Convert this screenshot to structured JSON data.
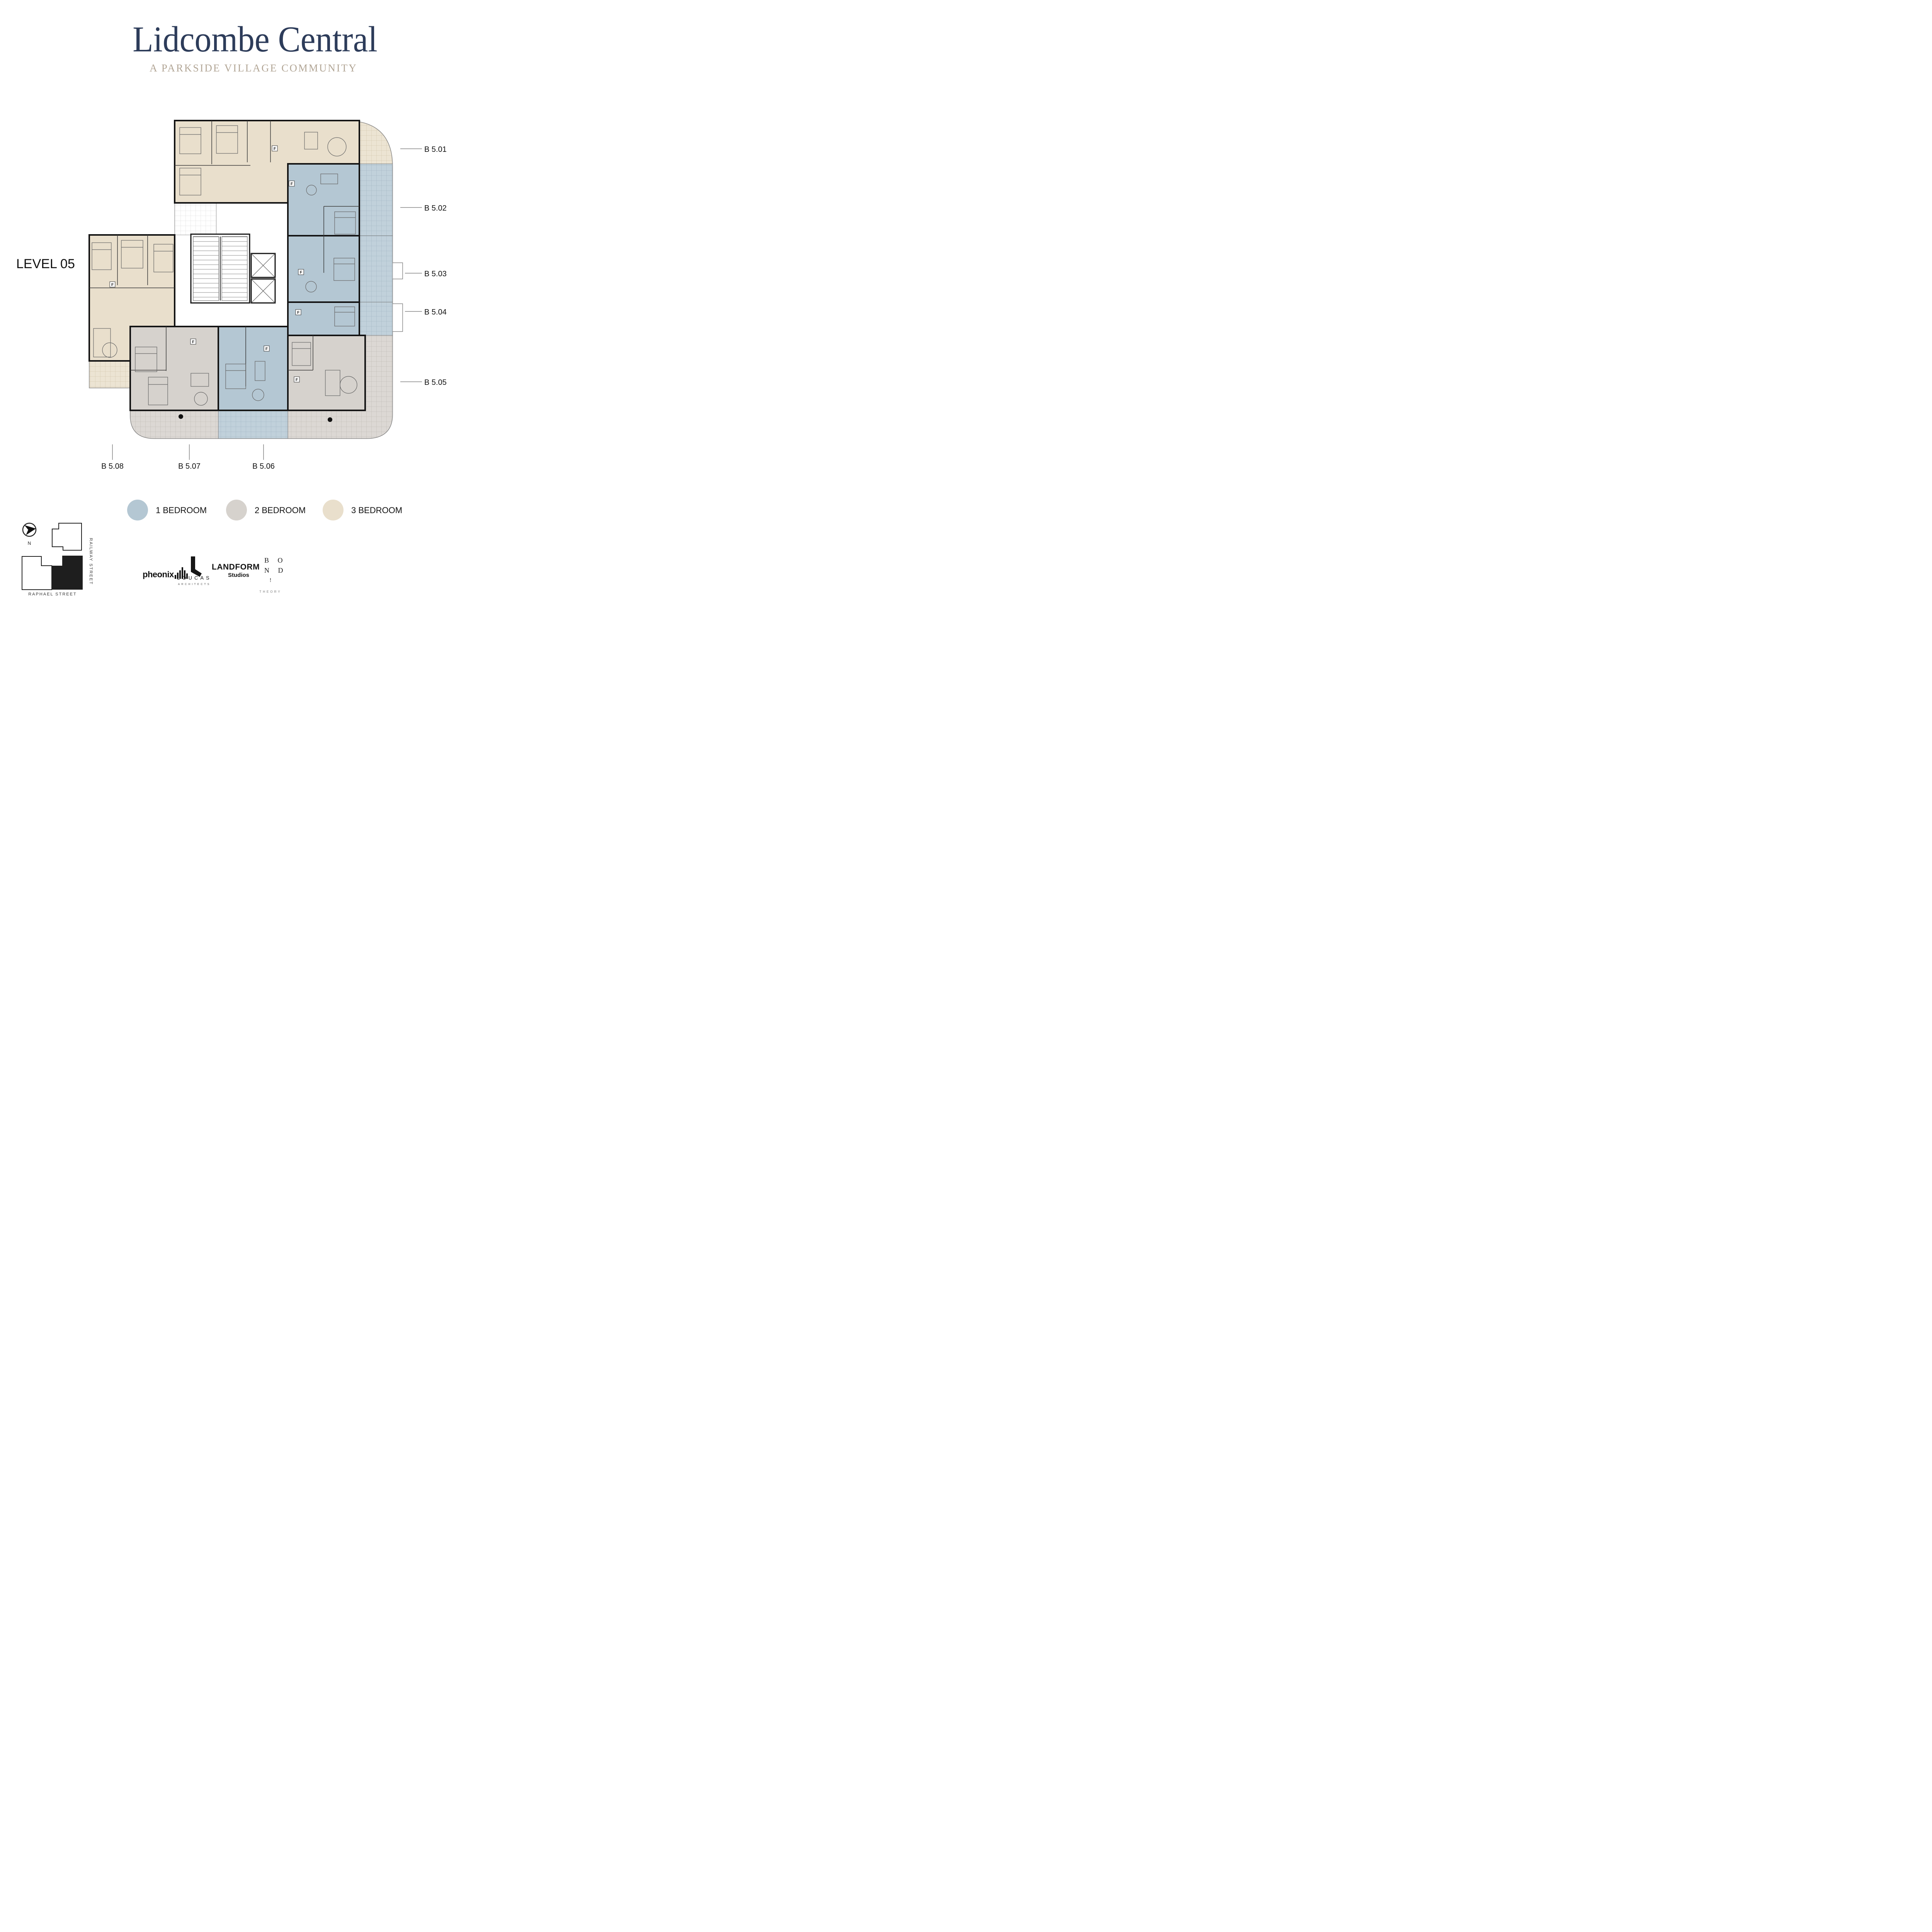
{
  "header": {
    "title": "Lidcombe Central",
    "subtitle": "A PARKSIDE VILLAGE COMMUNITY"
  },
  "plan": {
    "level_label": "LEVEL 05",
    "f_marker_label": "F",
    "units": [
      {
        "id": "B5.01",
        "label": "B 5.01",
        "type": "3 Bedroom",
        "label_side": "right"
      },
      {
        "id": "B5.02",
        "label": "B 5.02",
        "type": "1 Bedroom",
        "label_side": "right"
      },
      {
        "id": "B5.03",
        "label": "B 5.03",
        "type": "1 Bedroom",
        "label_side": "right"
      },
      {
        "id": "B5.04",
        "label": "B 5.04",
        "type": "1 Bedroom",
        "label_side": "right"
      },
      {
        "id": "B5.05",
        "label": "B 5.05",
        "type": "2 Bedroom",
        "label_side": "right"
      },
      {
        "id": "B5.06",
        "label": "B 5.06",
        "type": "1 Bedroom",
        "label_side": "bottom"
      },
      {
        "id": "B5.07",
        "label": "B 5.07",
        "type": "2 Bedroom",
        "label_side": "bottom"
      },
      {
        "id": "B5.08",
        "label": "B 5.08",
        "type": "3 Bedroom",
        "label_side": "bottom"
      }
    ]
  },
  "legend": {
    "items": [
      {
        "label": "1 BEDROOM",
        "color": "#b4c7d3"
      },
      {
        "label": "2 BEDROOM",
        "color": "#d6d2cd"
      },
      {
        "label": "3 BEDROOM",
        "color": "#e9dfcc"
      }
    ]
  },
  "colors": {
    "title_navy": "#2d3c5a",
    "subtitle_taupe": "#b2a696",
    "one_bedroom": "#b4c7d3",
    "two_bedroom": "#d6d2cd",
    "three_bedroom": "#e9dfcc",
    "wall_black": "#141414"
  },
  "logos": {
    "pheonix": {
      "name": "pheonix"
    },
    "loucas": {
      "glyph": "L",
      "name": "LOUCAS",
      "sub": "ARCHITECTS"
    },
    "landform": {
      "name": "LANDFORM",
      "sub": "Studios"
    },
    "bond": {
      "row1": "B O",
      "row2": "N D",
      "mark": "!",
      "sub": "THEORY"
    }
  },
  "sitemap": {
    "north_label": "N",
    "street_right": "RAILWAY STREET",
    "street_bottom": "RAPHAEL STREET"
  }
}
